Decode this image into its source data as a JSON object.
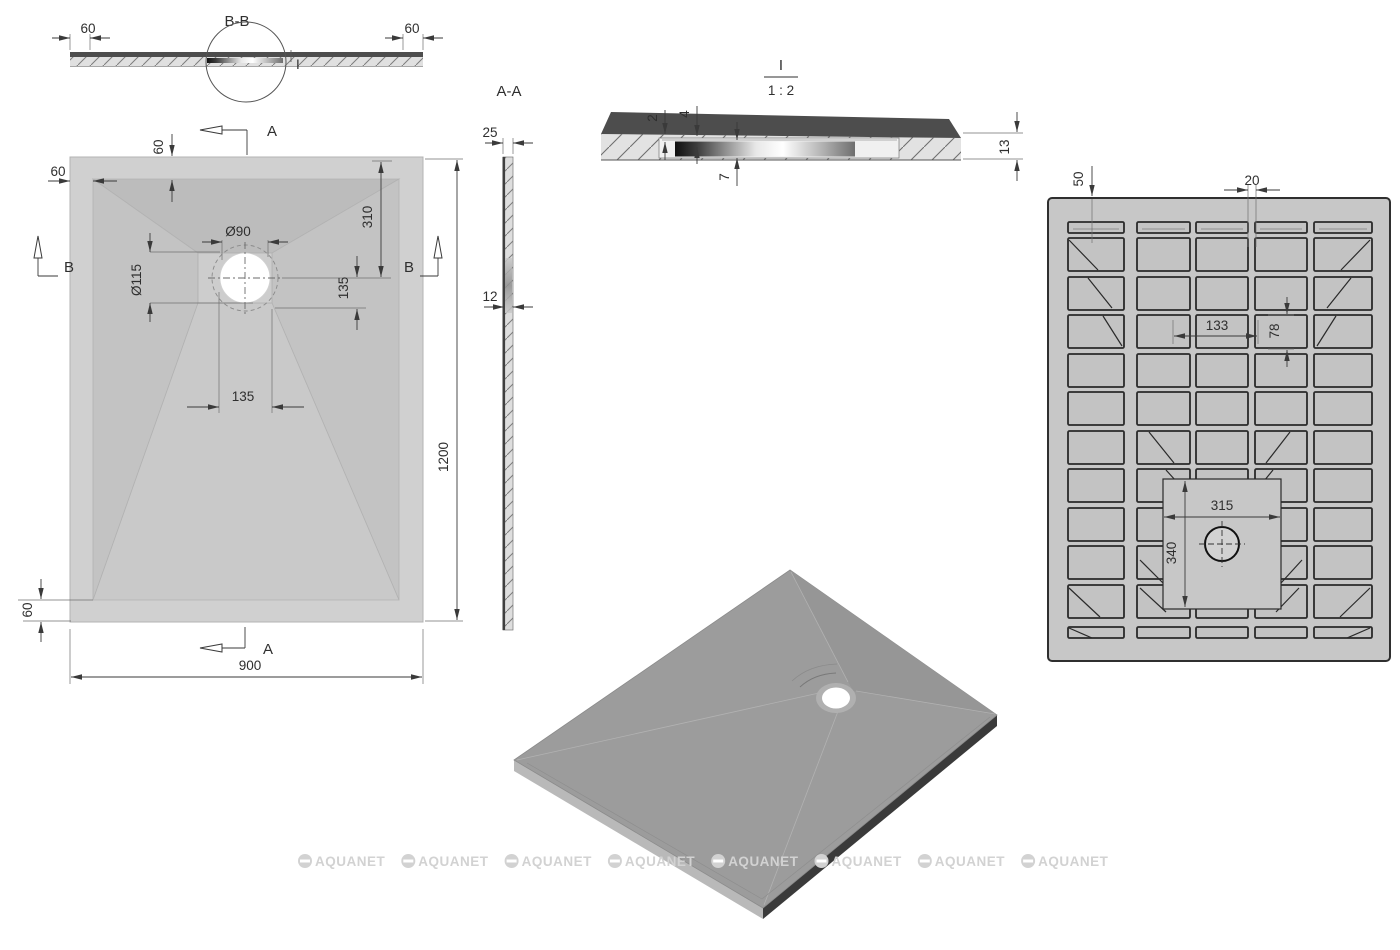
{
  "views": {
    "section_bb": {
      "title": "B-B",
      "detail_mark": "I",
      "dim_left_rim": "60",
      "dim_right_rim": "60"
    },
    "plan": {
      "dim_rim_left": "60",
      "dim_rim_top": "60",
      "dim_rim_bottom": "60",
      "dim_drain_dia": "Ø90",
      "dim_flange_dia": "Ø115",
      "dim_drain_offset_top": "310",
      "dim_drain_offset_right": "135",
      "dim_drain_offset_bottom": "135",
      "dim_width": "900",
      "dim_length": "1200",
      "mark_a_top": "A",
      "mark_a_bottom": "A",
      "mark_b_left": "B",
      "mark_b_right": "B"
    },
    "section_aa": {
      "title": "A-A",
      "dim_edge": "25",
      "dim_body": "12"
    },
    "detail_i": {
      "title": "I",
      "scale": "1 : 2",
      "dim_lip": "2",
      "dim_step": "4",
      "dim_recess_depth": "7",
      "dim_thickness": "13"
    },
    "bottom": {
      "dim_edge_offset": "50",
      "dim_rib_width": "20",
      "dim_cell_width": "133",
      "dim_cell_height": "78",
      "dim_recess_width": "315",
      "dim_recess_height": "340"
    }
  },
  "watermark": {
    "text": "AQUANET",
    "count": 8
  },
  "colors": {
    "line": "#3a3a3a",
    "dark_surface": "#4d4d4d",
    "hatch_fill": "#e0e0e0",
    "plan_rim": "#d0d0d0",
    "plan_facet_top": "#bcbcbc",
    "plan_facet_side": "#c3c3c3",
    "plan_facet_bottom": "#c9c9c9",
    "plan_drain_square": "#cdcdcd",
    "grid_body": "#c7c7c7",
    "grid_cell": "#c3c3c3",
    "iso_top": "#9c9c9c",
    "iso_edge_dark": "#3a3a3a",
    "iso_edge_light": "#b9b9b9",
    "watermark": "#d2d2d2"
  }
}
